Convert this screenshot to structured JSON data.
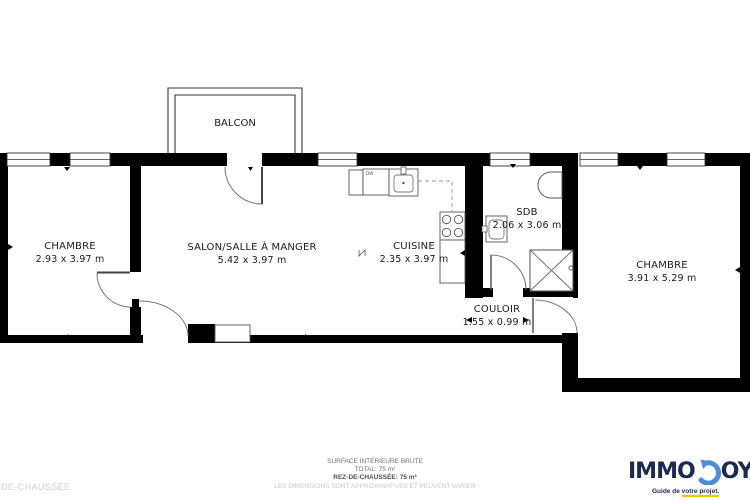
{
  "plan": {
    "balcony": {
      "label": "BALCON"
    },
    "rooms": [
      {
        "name": "chambre-left",
        "label": "CHAMBRE",
        "dims": "2.93 x 3.97 m"
      },
      {
        "name": "salon",
        "label": "SALON/SALLE À MANGER",
        "dims": "5.42 x 3.97 m"
      },
      {
        "name": "cuisine",
        "label": "CUISINE",
        "dims": "2.35 x 3.97 m"
      },
      {
        "name": "sdb",
        "label": "SDB",
        "dims": "2.06 x 3.06 m"
      },
      {
        "name": "couloir",
        "label": "COULOIR",
        "dims": "1.55 x 0.99 m"
      },
      {
        "name": "chambre-right",
        "label": "CHAMBRE",
        "dims": "3.91 x 5.29 m"
      }
    ],
    "appliance_labels": {
      "dishwasher": "DW"
    }
  },
  "footer": {
    "line1": "SURFACE INTÉRIEURE BRUTE",
    "line2": "TOTAL: 75 m²",
    "line3": "REZ-DE-CHAUSSÉE: 75 m²",
    "line4": "LES DIMENSIONS SONT APPROXIMATIVES ET PEUVENT VARIER",
    "floor_label": "DE-CHAUSSÉE"
  },
  "brand": {
    "name_left": "IMMO",
    "name_right": "OYE",
    "tagline_prefix": "Guide de ",
    "tagline_highlight": "votre projet.",
    "colors": {
      "navy": "#1b2a55",
      "blue": "#4a90d9",
      "yellow": "#f5c400"
    }
  }
}
